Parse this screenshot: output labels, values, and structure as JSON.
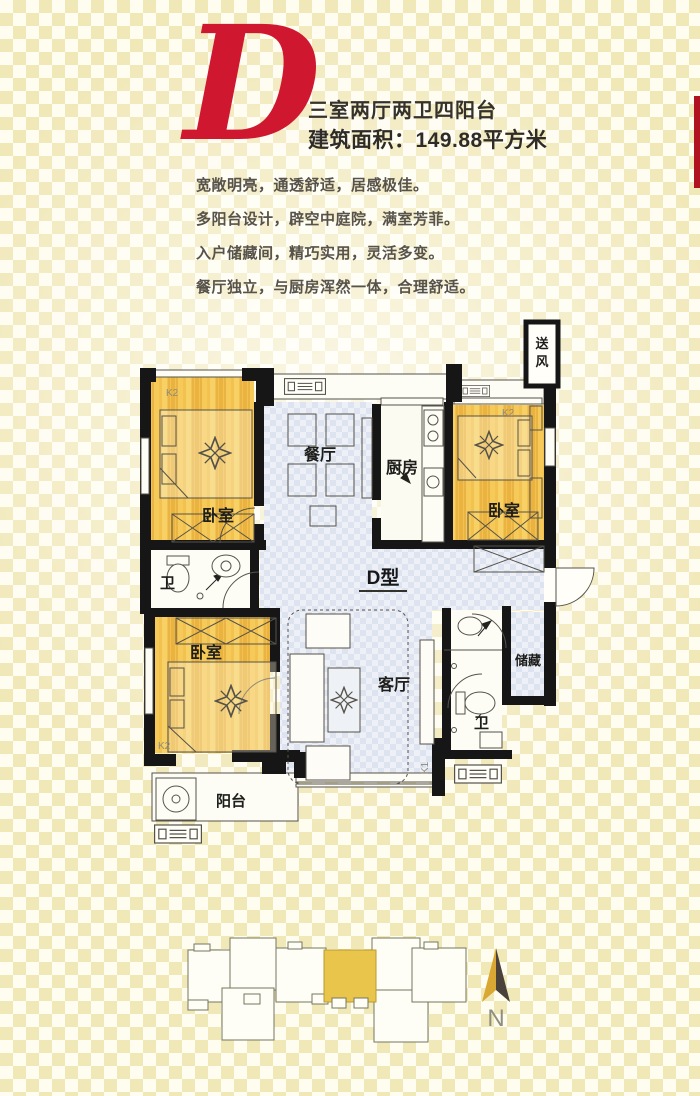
{
  "header": {
    "letter": "D",
    "title": "三室两厅两卫四阳台",
    "area": "建筑面积：149.88平方米"
  },
  "description": {
    "lines": [
      "宽敞明亮，通透舒适，居感极佳。",
      "多阳台设计，辟空中庭院，满室芳菲。",
      "入户储藏间，精巧实用，灵活多变。",
      "餐厅独立，与厨房浑然一体，合理舒适。"
    ]
  },
  "plan": {
    "type_label": "D型",
    "labels": {
      "bedroom_tl": "卧室",
      "bedroom_tr": "卧室",
      "bedroom_bl": "卧室",
      "dining": "餐厅",
      "kitchen": "厨房",
      "living": "客厅",
      "bath_left": "卫",
      "bath_right": "卫",
      "storage": "储藏",
      "balcony": "阳台"
    },
    "shaft_chars": [
      "送",
      "风"
    ],
    "codes": {
      "k2_tl": "K2",
      "k2_tr": "K2",
      "k2_bl": "K2",
      "k1": "K1"
    }
  },
  "site": {
    "north": "N"
  },
  "colors": {
    "accent_red": "#cf1830",
    "wood": "#f2c14e",
    "hall_blue": "#dfe5f0",
    "highlight_unit": "#e9c64b",
    "wall": "#161616"
  }
}
